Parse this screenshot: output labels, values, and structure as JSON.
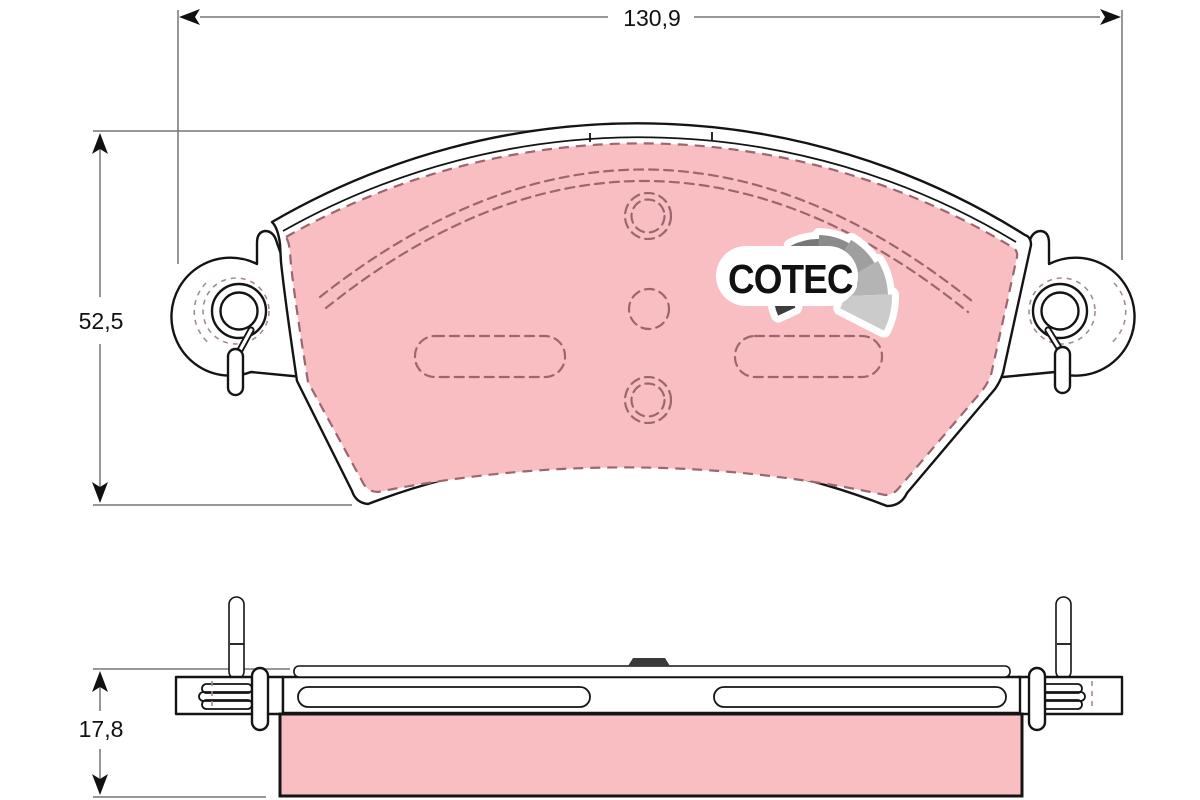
{
  "dimensions": {
    "width": "130,9",
    "height": "52,5",
    "thickness": "17,8"
  },
  "logo": {
    "text": "COTEC",
    "fan_colors": [
      "#3d3d3d",
      "#505050",
      "#636363",
      "#777777",
      "#8b8b8b",
      "#9f9f9f",
      "#b4b4b4",
      "#cbcbcb"
    ]
  },
  "colors": {
    "background": "#ffffff",
    "outline": "#141414",
    "friction_material": "#f9bec2",
    "detail_dash": "#9c666e",
    "dimension_line": "#757575",
    "dimension_text": "#111111",
    "wear_tab": "#3a3a3a",
    "logo_text": "#111111"
  }
}
